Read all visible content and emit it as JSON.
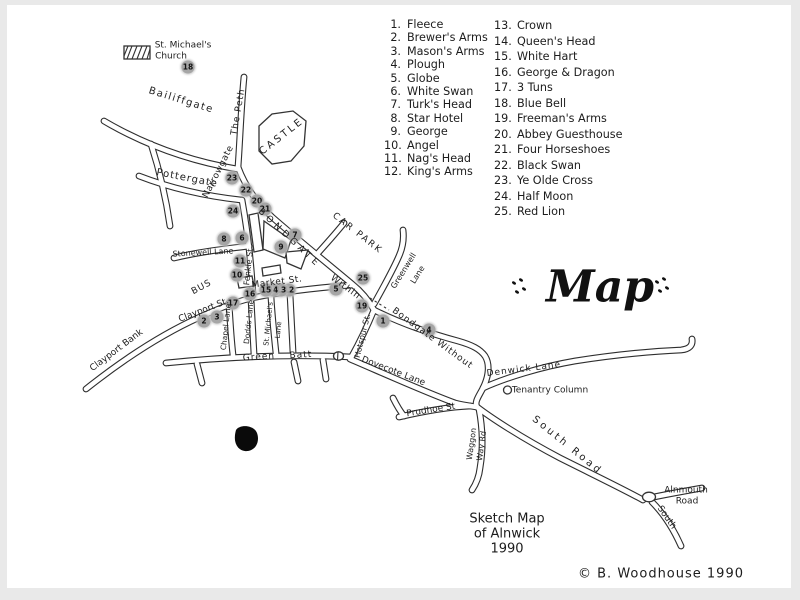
{
  "title": {
    "text": "Map"
  },
  "legend": {
    "column1": [
      {
        "n": 1,
        "name": "Fleece"
      },
      {
        "n": 2,
        "name": "Brewer's Arms"
      },
      {
        "n": 3,
        "name": "Mason's Arms"
      },
      {
        "n": 4,
        "name": "Plough"
      },
      {
        "n": 5,
        "name": "Globe"
      },
      {
        "n": 6,
        "name": "White Swan"
      },
      {
        "n": 7,
        "name": "Turk's Head"
      },
      {
        "n": 8,
        "name": "Star Hotel"
      },
      {
        "n": 9,
        "name": "George"
      },
      {
        "n": 10,
        "name": "Angel"
      },
      {
        "n": 11,
        "name": "Nag's Head"
      },
      {
        "n": 12,
        "name": "King's Arms"
      }
    ],
    "column2": [
      {
        "n": 13,
        "name": "Crown"
      },
      {
        "n": 14,
        "name": "Queen's Head"
      },
      {
        "n": 15,
        "name": "White Hart"
      },
      {
        "n": 16,
        "name": "George & Dragon"
      },
      {
        "n": 17,
        "name": "3 Tuns"
      },
      {
        "n": 18,
        "name": "Blue Bell"
      },
      {
        "n": 19,
        "name": "Freeman's Arms"
      },
      {
        "n": 20,
        "name": "Abbey Guesthouse"
      },
      {
        "n": 21,
        "name": "Four Horseshoes"
      },
      {
        "n": 22,
        "name": "Black Swan"
      },
      {
        "n": 23,
        "name": "Ye Olde Cross"
      },
      {
        "n": 24,
        "name": "Half Moon"
      },
      {
        "n": 25,
        "name": "Red Lion"
      }
    ]
  },
  "caption": {
    "line1": "Sketch Map",
    "line2": "of Alnwick",
    "line3": "1990"
  },
  "footer": {
    "copyright": "© B. Woodhouse  1990"
  },
  "colors": {
    "ink": "#2e2e2e",
    "paper": "#ffffff",
    "marker": "#a6a6a6"
  },
  "map": {
    "labels": [
      {
        "id": "st-michaels-church-label-1",
        "text": "St. Michael's",
        "x": 183,
        "y": 46,
        "rot": 0,
        "size": 9
      },
      {
        "id": "st-michaels-church-label-2",
        "text": "Church",
        "x": 171,
        "y": 57,
        "rot": 0,
        "size": 9
      },
      {
        "id": "bailiffgate-label",
        "text": "Bailiffgate",
        "x": 181,
        "y": 101,
        "rot": 17,
        "size": 10,
        "ls": 1.5
      },
      {
        "id": "the-peth-label",
        "text": "The Peth",
        "x": 239,
        "y": 112,
        "rot": -80,
        "size": 9,
        "ls": 1
      },
      {
        "id": "castle-label",
        "text": "CASTLE",
        "x": 282,
        "y": 137,
        "rot": -38,
        "size": 10,
        "ls": 2.5
      },
      {
        "id": "pottergate-label",
        "text": "Pottergate",
        "x": 187,
        "y": 179,
        "rot": 11,
        "size": 10,
        "ls": 1
      },
      {
        "id": "narrowgate-label",
        "text": "Narrowgate",
        "x": 219,
        "y": 172,
        "rot": -63,
        "size": 9,
        "ls": 0.5
      },
      {
        "id": "stonewell-lane-label",
        "text": "Stonewell Lane",
        "x": 203,
        "y": 253,
        "rot": -3,
        "size": 8
      },
      {
        "id": "bus-label",
        "text": "BUS",
        "x": 202,
        "y": 288,
        "rot": -28,
        "size": 9,
        "ls": 1
      },
      {
        "id": "fenkle-st-label",
        "text": "Fenkle St",
        "x": 249,
        "y": 267,
        "rot": -84,
        "size": 8
      },
      {
        "id": "market-st-label",
        "text": "Market St.",
        "x": 277,
        "y": 283,
        "rot": -7,
        "size": 9,
        "ls": 0.5
      },
      {
        "id": "bondgate-label",
        "text": "BONDGATE",
        "x": 289,
        "y": 239,
        "rot": 43,
        "size": 9,
        "ls": 4
      },
      {
        "id": "bondgate-within-label",
        "text": "Within",
        "x": 345,
        "y": 288,
        "rot": 36,
        "size": 9,
        "ls": 1
      },
      {
        "id": "car-park-label",
        "text": "CAR PARK",
        "x": 357,
        "y": 234,
        "rot": 38,
        "size": 9,
        "ls": 2
      },
      {
        "id": "greenwell-lane-label-1",
        "text": "Greenwell",
        "x": 404,
        "y": 271,
        "rot": -58,
        "size": 8
      },
      {
        "id": "greenwell-lane-label-2",
        "text": "Lane",
        "x": 418,
        "y": 275,
        "rot": -58,
        "size": 8
      },
      {
        "id": "hotspur-st-label",
        "text": "Hotspur St.",
        "x": 363,
        "y": 336,
        "rot": -76,
        "size": 8
      },
      {
        "id": "bondgate-without-label",
        "text": "Bondgate Without",
        "x": 432,
        "y": 339,
        "rot": 36,
        "size": 9,
        "ls": 1
      },
      {
        "id": "denwick-lane-label",
        "text": "Denwick Lane",
        "x": 524,
        "y": 370,
        "rot": -7,
        "size": 9,
        "ls": 1
      },
      {
        "id": "tenantry-column-label",
        "text": "Tenantry Column",
        "x": 550,
        "y": 391,
        "rot": 0,
        "size": 9
      },
      {
        "id": "dovecote-lane-label",
        "text": "Dovecote Lane",
        "x": 393,
        "y": 372,
        "rot": 21,
        "size": 9
      },
      {
        "id": "green-batt-label-1",
        "text": "Green",
        "x": 259,
        "y": 358,
        "rot": -4,
        "size": 9,
        "ls": 1
      },
      {
        "id": "green-batt-label-2",
        "text": "Batt",
        "x": 301,
        "y": 356,
        "rot": -4,
        "size": 9,
        "ls": 1
      },
      {
        "id": "clayport-st-label",
        "text": "Clayport St.",
        "x": 204,
        "y": 311,
        "rot": -21,
        "size": 9
      },
      {
        "id": "clayport-bank-label",
        "text": "Clayport Bank",
        "x": 117,
        "y": 351,
        "rot": -37,
        "size": 9
      },
      {
        "id": "chapel-lane-label",
        "text": "Chapel Lane",
        "x": 226,
        "y": 327,
        "rot": -84,
        "size": 7.5
      },
      {
        "id": "dodds-lane-label",
        "text": "Dodds Lane",
        "x": 249,
        "y": 322,
        "rot": -84,
        "size": 7.5
      },
      {
        "id": "st-michaels-lane-label-1",
        "text": "St. Michael's",
        "x": 269,
        "y": 324,
        "rot": -84,
        "size": 7
      },
      {
        "id": "st-michaels-lane-label-2",
        "text": "Lane",
        "x": 279,
        "y": 330,
        "rot": -84,
        "size": 7
      },
      {
        "id": "prudhoe-st-label",
        "text": "Prudhoe St",
        "x": 431,
        "y": 411,
        "rot": -9,
        "size": 9
      },
      {
        "id": "waggon-way-label-1",
        "text": "Waggon",
        "x": 472,
        "y": 444,
        "rot": -82,
        "size": 8
      },
      {
        "id": "waggon-way-label-2",
        "text": "Way Rd",
        "x": 482,
        "y": 446,
        "rot": -82,
        "size": 8
      },
      {
        "id": "south-road-label",
        "text": "South Road",
        "x": 567,
        "y": 446,
        "rot": 39,
        "size": 10,
        "ls": 3
      },
      {
        "id": "alnmouth-road-label-1",
        "text": "Alnmouth",
        "x": 686,
        "y": 491,
        "rot": 0,
        "size": 9
      },
      {
        "id": "alnmouth-road-label-2",
        "text": "Road",
        "x": 687,
        "y": 502,
        "rot": 0,
        "size": 9
      },
      {
        "id": "south-fork-label",
        "text": "South",
        "x": 666,
        "y": 518,
        "rot": 55,
        "size": 9
      }
    ],
    "markers": [
      {
        "n": 1,
        "x": 383,
        "y": 321
      },
      {
        "n": 2,
        "x": 204,
        "y": 321
      },
      {
        "n": 3,
        "x": 217,
        "y": 317
      },
      {
        "n": 4,
        "x": 429,
        "y": 330
      },
      {
        "n": 5,
        "x": 336,
        "y": 289
      },
      {
        "n": 6,
        "x": 242,
        "y": 238
      },
      {
        "n": 7,
        "x": 295,
        "y": 235
      },
      {
        "n": 8,
        "x": 224,
        "y": 239
      },
      {
        "n": 9,
        "x": 281,
        "y": 247
      },
      {
        "n": 10,
        "x": 237,
        "y": 275
      },
      {
        "n": 11,
        "x": 240,
        "y": 261
      },
      {
        "n": 12,
        "x": 289,
        "y": 290
      },
      {
        "n": 13,
        "x": 281,
        "y": 290
      },
      {
        "n": 14,
        "x": 273,
        "y": 290
      },
      {
        "n": 15,
        "x": 266,
        "y": 290
      },
      {
        "n": 16,
        "x": 250,
        "y": 294
      },
      {
        "n": 17,
        "x": 233,
        "y": 303
      },
      {
        "n": 18,
        "x": 188,
        "y": 67
      },
      {
        "n": 19,
        "x": 362,
        "y": 306
      },
      {
        "n": 20,
        "x": 257,
        "y": 201
      },
      {
        "n": 21,
        "x": 265,
        "y": 209
      },
      {
        "n": 22,
        "x": 246,
        "y": 190
      },
      {
        "n": 23,
        "x": 232,
        "y": 178
      },
      {
        "n": 24,
        "x": 233,
        "y": 211
      },
      {
        "n": 25,
        "x": 363,
        "y": 278
      }
    ]
  }
}
